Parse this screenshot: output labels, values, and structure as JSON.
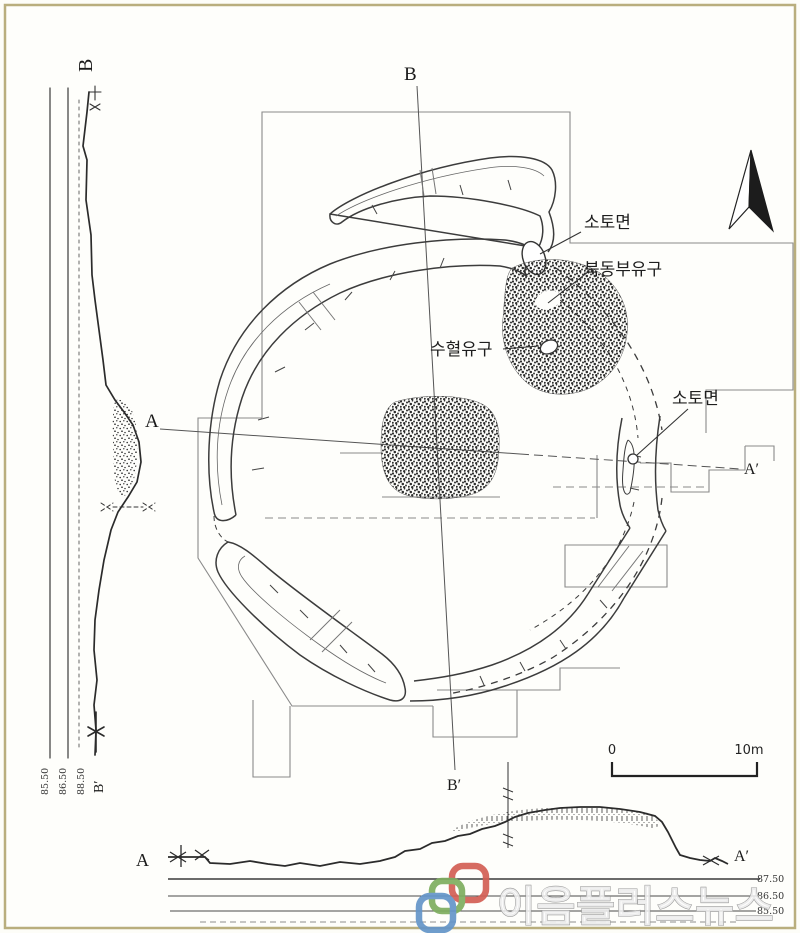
{
  "figure_title": "archaeological ring-ditch plan and sections",
  "plan": {
    "labels": {
      "b_top": "B",
      "b_bottom": "B′",
      "a_left": "A",
      "a_right": "A′"
    },
    "annotations": {
      "soto_top": "소토면",
      "northeast_feature": "북동부유구",
      "pit_feature": "수혈유구",
      "soto_right": "소토면"
    },
    "north_arrow_icon": "north-arrow",
    "scale_bar": {
      "zero": "0",
      "ten": "10m"
    }
  },
  "left_section": {
    "label_top": "B",
    "label_bottom": "B′",
    "elevations": [
      "85.50",
      "86.50",
      "88.50"
    ]
  },
  "bottom_section": {
    "label_left": "A",
    "label_right": "A′",
    "elevations": [
      "87.50",
      "86.50",
      "85.50"
    ]
  },
  "watermark": {
    "text": "이음플러스뉴스",
    "link_colors": {
      "green": "#7fae5f",
      "red": "#d35f55",
      "blue": "#6495c9"
    }
  }
}
